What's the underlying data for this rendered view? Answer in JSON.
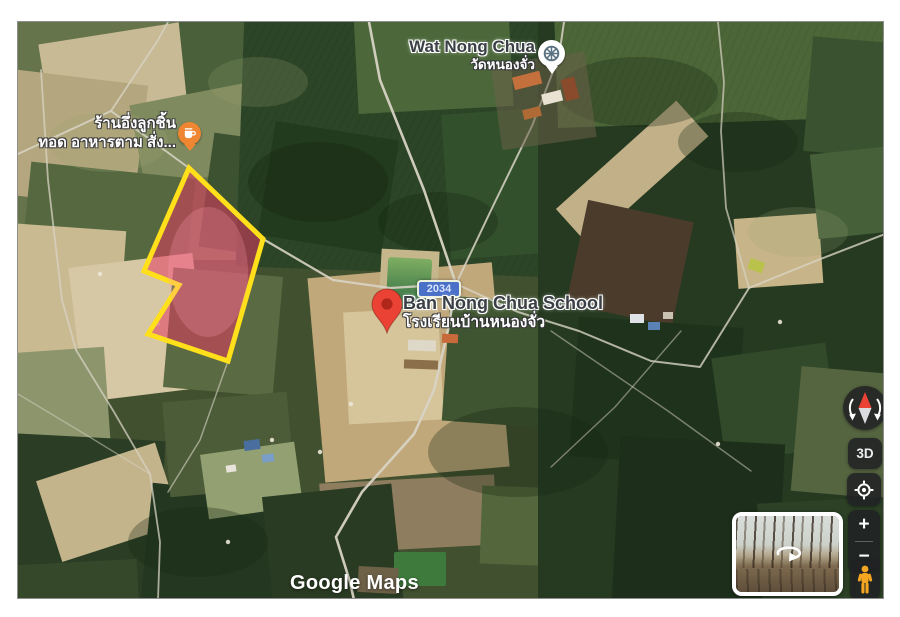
{
  "map": {
    "google_logo": "Google Maps",
    "route_badge": "2034",
    "temple": {
      "name": "Wat Nong Chua",
      "thai": "วัดหนองจั่ว"
    },
    "restaurant": {
      "line1": "ร้านอึ่งลูกชิ้น",
      "line2": "ทอด อาหารตาม สั่ง..."
    },
    "school": {
      "name": "Ban Nong Chua School",
      "thai": "โรงเรียนบ้านหนองจั่ว"
    },
    "controls": {
      "three_d": "3D",
      "zoom_in": "+",
      "zoom_out": "−"
    },
    "colors": {
      "plot_fill": "#e23b63",
      "plot_stroke": "#ffe01a",
      "pin": "#ea4335",
      "pin_inner": "#b0271a",
      "badge_bg": "#4a70c8",
      "pegman": "#f6a722",
      "compass_north": "#ea4335",
      "restaurant_icon": "#ef8632"
    }
  }
}
